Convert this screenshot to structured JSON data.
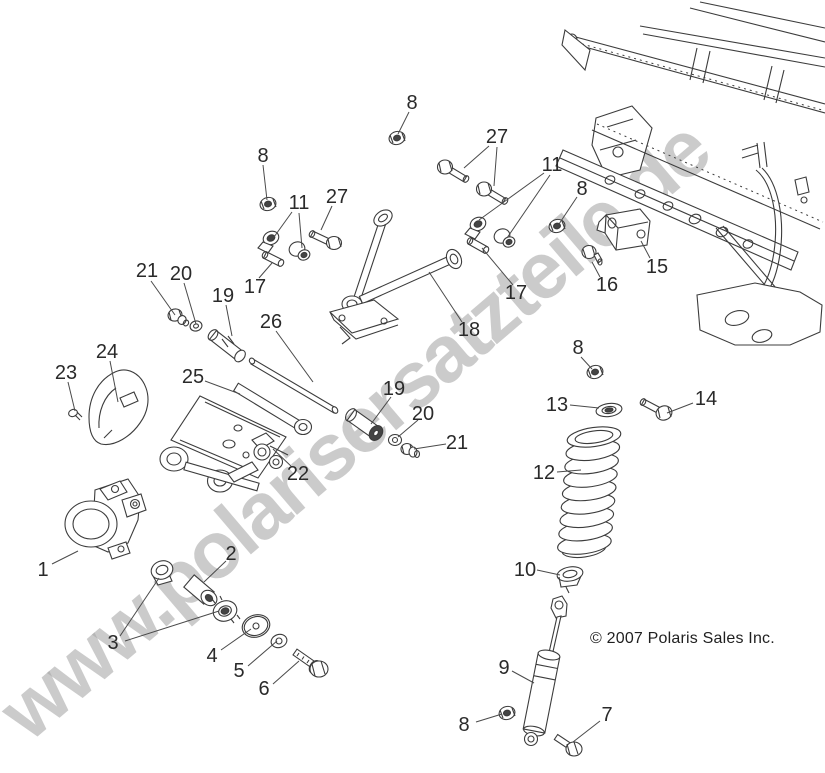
{
  "watermark": {
    "text": "www.polarisersatzteile.de",
    "color": "#a8a8a8"
  },
  "copyright": {
    "text": "© 2007 Polaris Sales Inc."
  },
  "style": {
    "label_color": "#2a2a2a",
    "leader_color": "#4a4a4a",
    "line_color": "#3c3c3c",
    "background": "#ffffff"
  },
  "callouts": [
    {
      "text": "8",
      "x": 412,
      "y": 102,
      "leaders": [
        [
          409,
          112,
          398,
          134
        ]
      ]
    },
    {
      "text": "27",
      "x": 497,
      "y": 136,
      "leaders": [
        [
          489,
          146,
          464,
          168
        ],
        [
          497,
          147,
          494,
          186
        ]
      ]
    },
    {
      "text": "11",
      "x": 552,
      "y": 164,
      "leaders": [
        [
          544,
          173,
          479,
          220
        ],
        [
          550,
          175,
          507,
          238
        ]
      ]
    },
    {
      "text": "8",
      "x": 582,
      "y": 188,
      "leaders": [
        [
          577,
          197,
          559,
          224
        ]
      ]
    },
    {
      "text": "8",
      "x": 263,
      "y": 155,
      "leaders": [
        [
          263,
          165,
          267,
          200
        ]
      ]
    },
    {
      "text": "11",
      "x": 299,
      "y": 202,
      "leaders": [
        [
          292,
          212,
          274,
          237
        ],
        [
          299,
          213,
          302,
          248
        ]
      ]
    },
    {
      "text": "27",
      "x": 337,
      "y": 196,
      "leaders": [
        [
          332,
          206,
          321,
          230
        ]
      ]
    },
    {
      "text": "15",
      "x": 657,
      "y": 266,
      "leaders": [
        [
          650,
          258,
          641,
          241
        ]
      ]
    },
    {
      "text": "16",
      "x": 607,
      "y": 284,
      "leaders": [
        [
          600,
          277,
          592,
          262
        ]
      ]
    },
    {
      "text": "17",
      "x": 255,
      "y": 286,
      "leaders": [
        [
          259,
          278,
          272,
          263
        ]
      ]
    },
    {
      "text": "17",
      "x": 516,
      "y": 292,
      "leaders": [
        [
          513,
          285,
          482,
          248
        ]
      ]
    },
    {
      "text": "18",
      "x": 469,
      "y": 329,
      "leaders": [
        [
          462,
          322,
          429,
          272
        ]
      ]
    },
    {
      "text": "8",
      "x": 578,
      "y": 347,
      "leaders": [
        [
          581,
          357,
          592,
          369
        ]
      ]
    },
    {
      "text": "26",
      "x": 271,
      "y": 321,
      "leaders": [
        [
          276,
          331,
          313,
          382
        ]
      ]
    },
    {
      "text": "19",
      "x": 223,
      "y": 295,
      "leaders": [
        [
          226,
          305,
          232,
          336
        ]
      ]
    },
    {
      "text": "20",
      "x": 181,
      "y": 273,
      "leaders": [
        [
          184,
          283,
          196,
          324
        ]
      ]
    },
    {
      "text": "21",
      "x": 147,
      "y": 270,
      "leaders": [
        [
          151,
          281,
          175,
          315
        ]
      ]
    },
    {
      "text": "24",
      "x": 107,
      "y": 351,
      "leaders": [
        [
          110,
          361,
          118,
          402
        ]
      ]
    },
    {
      "text": "23",
      "x": 66,
      "y": 372,
      "leaders": [
        [
          68,
          382,
          75,
          411
        ]
      ]
    },
    {
      "text": "25",
      "x": 193,
      "y": 376,
      "leaders": [
        [
          205,
          381,
          240,
          394
        ]
      ]
    },
    {
      "text": "22",
      "x": 298,
      "y": 473,
      "leaders": [
        [
          292,
          467,
          273,
          449
        ]
      ]
    },
    {
      "text": "19",
      "x": 394,
      "y": 388,
      "leaders": [
        [
          391,
          397,
          371,
          424
        ]
      ]
    },
    {
      "text": "20",
      "x": 423,
      "y": 413,
      "leaders": [
        [
          418,
          420,
          398,
          437
        ]
      ]
    },
    {
      "text": "21",
      "x": 457,
      "y": 442,
      "leaders": [
        [
          446,
          444,
          414,
          449
        ]
      ]
    },
    {
      "text": "1",
      "x": 43,
      "y": 569,
      "leaders": [
        [
          52,
          564,
          78,
          551
        ]
      ]
    },
    {
      "text": "2",
      "x": 231,
      "y": 553,
      "leaders": [
        [
          226,
          561,
          204,
          582
        ]
      ]
    },
    {
      "text": "3",
      "x": 113,
      "y": 642,
      "leaders": [
        [
          120,
          636,
          159,
          578
        ],
        [
          125,
          641,
          219,
          611
        ]
      ]
    },
    {
      "text": "4",
      "x": 212,
      "y": 655,
      "leaders": [
        [
          221,
          650,
          251,
          629
        ]
      ]
    },
    {
      "text": "5",
      "x": 239,
      "y": 670,
      "leaders": [
        [
          248,
          666,
          277,
          641
        ]
      ]
    },
    {
      "text": "6",
      "x": 264,
      "y": 688,
      "leaders": [
        [
          273,
          684,
          299,
          661
        ]
      ]
    },
    {
      "text": "13",
      "x": 557,
      "y": 404,
      "leaders": [
        [
          570,
          405,
          599,
          408
        ]
      ]
    },
    {
      "text": "14",
      "x": 706,
      "y": 398,
      "leaders": [
        [
          693,
          403,
          667,
          413
        ]
      ]
    },
    {
      "text": "12",
      "x": 544,
      "y": 472,
      "leaders": [
        [
          557,
          472,
          581,
          470
        ]
      ]
    },
    {
      "text": "10",
      "x": 525,
      "y": 569,
      "leaders": [
        [
          537,
          570,
          560,
          575
        ]
      ]
    },
    {
      "text": "9",
      "x": 504,
      "y": 667,
      "leaders": [
        [
          512,
          671,
          534,
          683
        ]
      ]
    },
    {
      "text": "8",
      "x": 464,
      "y": 724,
      "leaders": [
        [
          476,
          722,
          502,
          714
        ]
      ]
    },
    {
      "text": "7",
      "x": 607,
      "y": 714,
      "leaders": [
        [
          600,
          721,
          573,
          742
        ]
      ]
    }
  ]
}
